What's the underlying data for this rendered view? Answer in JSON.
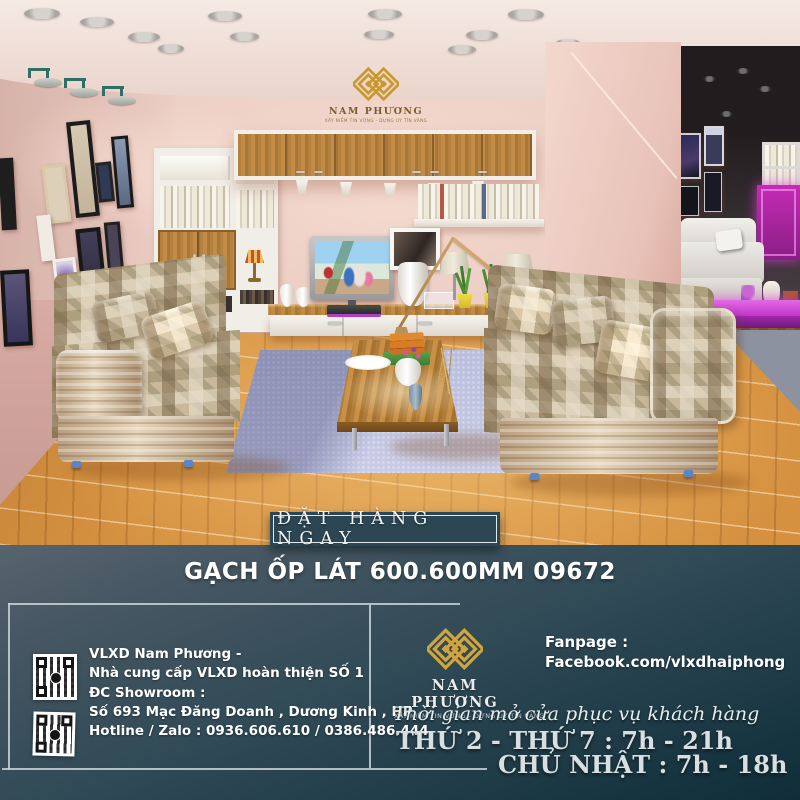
{
  "brand": {
    "name": "NAM PHƯƠNG",
    "tagline": "XÂY NIỀM TIN VỮNG - DỰNG UY TÍN VÀNG"
  },
  "cta": {
    "label": "ĐẶT HÀNG NGAY"
  },
  "headline": {
    "text": "GẠCH ỐP LÁT 600.600MM 09672"
  },
  "contact": {
    "lines": [
      "VLXD Nam Phương -",
      "Nhà cung cấp VLXD hoàn thiện SỐ 1",
      "ĐC Showroom :",
      "Số 693 Mạc Đăng Doanh , Dương Kinh , HP",
      "Hotline / Zalo : 0936.606.610 / 0386.486.444"
    ]
  },
  "fanpage": {
    "label": "Fanpage :",
    "url": "Facebook.com/vlxdhaiphong"
  },
  "hours": {
    "title": "Thời gian mở cửa phục vụ khách hàng",
    "weekdays": "THỨ 2 - THỨ 7 : 7h - 21h",
    "sunday": "CHỦ NHẬT : 7h - 18h"
  },
  "icons": {
    "brand_mark": "diamond-weave-logo",
    "qr": "qr-code"
  },
  "colors": {
    "gold": "#c9992e",
    "footer_top": "#56646e",
    "footer_bottom": "#102d38",
    "button_bg": "#2c4753",
    "wall_pink": "#e9cbc2",
    "floor_wood": "#d59140",
    "rug": "#c0c5e1",
    "purple_accent": "#cc3fd6",
    "text_light": "#e7edef"
  }
}
